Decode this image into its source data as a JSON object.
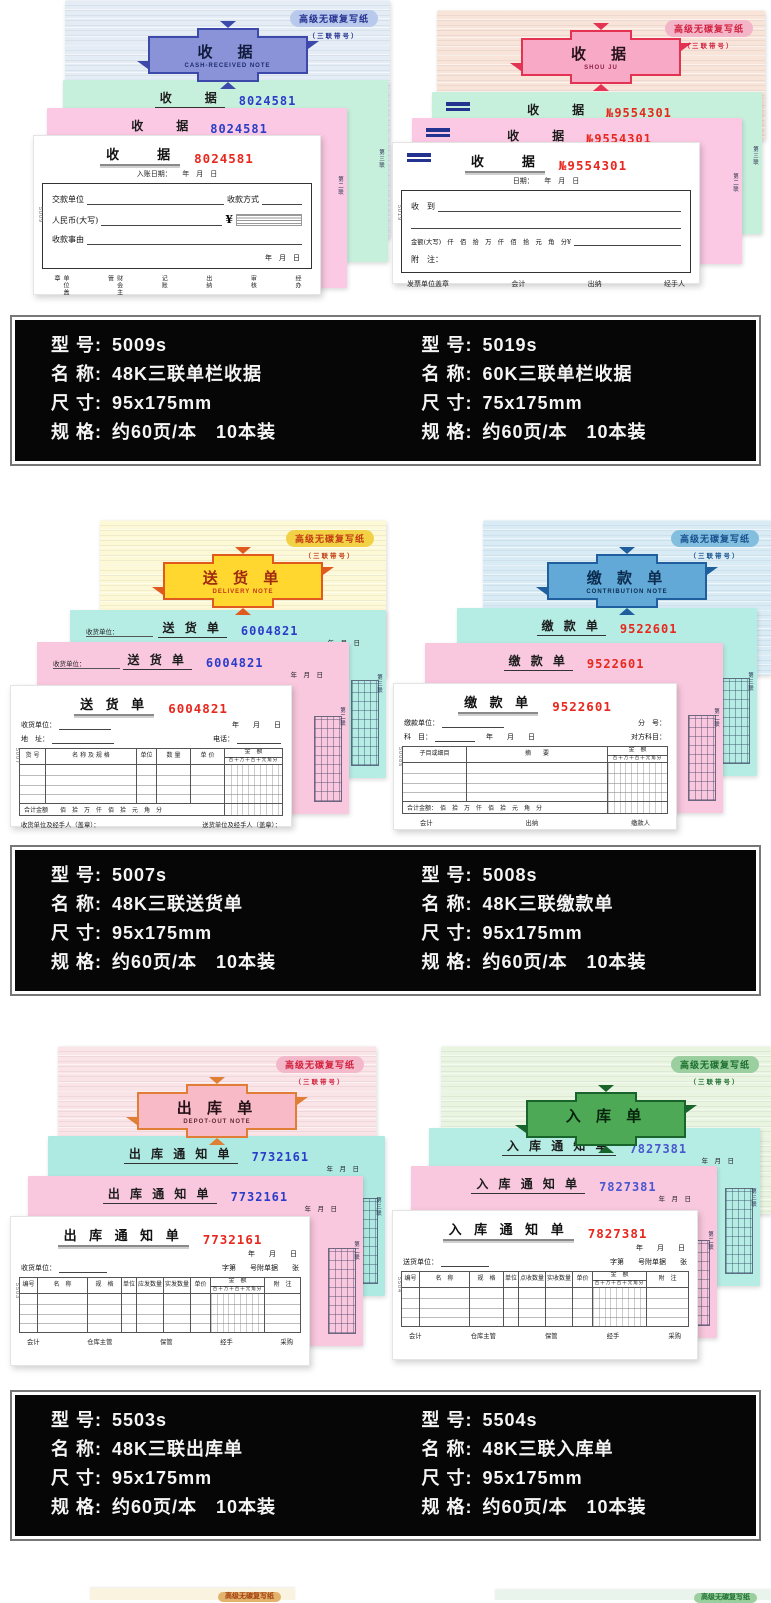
{
  "page": {
    "badge_text": "高级无碳复写纸",
    "badge_sub": "（三联带号）"
  },
  "products": [
    {
      "banner_title": "收　据",
      "banner_sub": "CASH-RECEIVED NOTE",
      "serial": "8024581",
      "sheet_title": "收　　据",
      "vtext1": "第三联",
      "vtext2": "第二联",
      "form": {
        "date": "入账日期：　　年　月　日",
        "f1": "交款单位",
        "f1b": "收款方式",
        "f2": "人民币(大写)",
        "yen": "¥",
        "f3": "收款事由",
        "date2": "年　月　日",
        "footer": [
          "单位盖章",
          "财会主管",
          "记账",
          "出纳",
          "审核",
          "经办"
        ],
        "code": "5009"
      }
    },
    {
      "banner_title": "收　据",
      "banner_sub": "SHOU JU",
      "serial": "№9554301",
      "sheet_title": "收　　据",
      "vtext1": "第三联",
      "vtext2": "第二联",
      "form": {
        "date": "日期：　　年　月　日",
        "f1": "收　到",
        "f2": "金额(大写)　仟　佰　拾　万　仟　佰　拾　元　角　分¥",
        "f3": "附　注：",
        "footer": [
          "发票单位盖章",
          "会计",
          "出纳",
          "经手人"
        ],
        "code": "5019"
      }
    },
    {
      "banner_title": "送 货 单",
      "banner_sub": "DELIVERY NOTE",
      "serial": "6004821",
      "sheet_title": "送 货 单",
      "sheet_pre": "收货单位：",
      "sheet_date": "年　月　日",
      "vtext1": "第三联",
      "vtext2": "第二联",
      "form": {
        "pre": "收货单位：",
        "date": "年　　月　　日",
        "addr": "地　址：",
        "tel": "电话：",
        "headers": [
          "货 号",
          "名 称 及 规 格",
          "单位",
          "数 量",
          "单 价",
          "金　额"
        ],
        "digits": "百十万千百十元角分",
        "amount_row": "合计金额　　佰　拾　万　仟　佰　拾　元　角　分",
        "footer": [
          "收货单位及经手人（盖章）：",
          "送货单位及经手人（盖章）："
        ],
        "code": "5007"
      }
    },
    {
      "banner_title": "缴 款 单",
      "banner_sub": "CONTRIBUTION NOTE",
      "serial": "9522601",
      "sheet_title": "缴 款 单",
      "vtext1": "第三联",
      "vtext2": "第二联",
      "form": {
        "f1": "缴款单位：",
        "f1b": "分　号：",
        "f2": "科　目：",
        "f2m": "年　　月　　日",
        "f2b": "对方科目：",
        "headers": [
          "子目或细目",
          "摘　　要",
          "金　额"
        ],
        "digits": "百十万千百十元角分",
        "amount_row": "合计金额：　佰　拾　万　仟　佰　拾　元　角　分",
        "footer": [
          "会计",
          "出纳",
          "缴款人"
        ],
        "code": "5008s"
      }
    },
    {
      "banner_title": "出 库 单",
      "banner_sub": "DEPOT-OUT NOTE",
      "serial": "7732161",
      "sheet_title": "出 库 通 知 单",
      "sheet_date": "年　月　日",
      "vtext1": "第三联",
      "vtext2": "第二联",
      "form": {
        "date": "年　　月　　日",
        "f1": "收货单位：",
        "f1b": "字第　　号附单据　　张",
        "headers": [
          "编号",
          "名　称",
          "规　格",
          "单位",
          "应发数量",
          "实发数量",
          "单价",
          "金　额",
          "附　注"
        ],
        "digits": "百十万千百十元角分",
        "footer": [
          "会计",
          "仓库主管",
          "保管",
          "经手",
          "采购"
        ],
        "code": "5503"
      }
    },
    {
      "banner_title": "入 库 单",
      "banner_sub": "",
      "serial": "7827381",
      "sheet_title": "入 库 通 知 单",
      "sheet_date": "年　月　日",
      "vtext1": "第三联",
      "vtext2": "第二联",
      "form": {
        "date": "年　　月　　日",
        "f1": "送货单位：",
        "f1b": "字第　　号附单据　　张",
        "headers": [
          "编号",
          "名　称",
          "规　格",
          "单位",
          "点收数量",
          "实收数量",
          "单价",
          "金　额",
          "附　注"
        ],
        "digits": "百十万千百十元角分",
        "footer": [
          "会计",
          "仓库主管",
          "保管",
          "经手",
          "采购"
        ],
        "code": "5504"
      }
    }
  ],
  "spec_labels": {
    "model": "型 号:",
    "name": "名 称:",
    "size": "尺 寸:",
    "spec": "规 格:"
  },
  "specs": [
    {
      "left": {
        "model": "5009s",
        "name": "48K三联单栏收据",
        "size": "95x175mm",
        "spec": "约60页/本　10本装"
      },
      "right": {
        "model": "5019s",
        "name": "60K三联单栏收据",
        "size": "75x175mm",
        "spec": "约60页/本　10本装"
      }
    },
    {
      "left": {
        "model": "5007s",
        "name": "48K三联送货单",
        "size": "95x175mm",
        "spec": "约60页/本　10本装"
      },
      "right": {
        "model": "5008s",
        "name": "48K三联缴款单",
        "size": "95x175mm",
        "spec": "约60页/本　10本装"
      }
    },
    {
      "left": {
        "model": "5503s",
        "name": "48K三联出库单",
        "size": "95x175mm",
        "spec": "约60页/本　10本装"
      },
      "right": {
        "model": "5504s",
        "name": "48K三联入库单",
        "size": "95x175mm",
        "spec": "约60页/本　10本装"
      }
    }
  ]
}
